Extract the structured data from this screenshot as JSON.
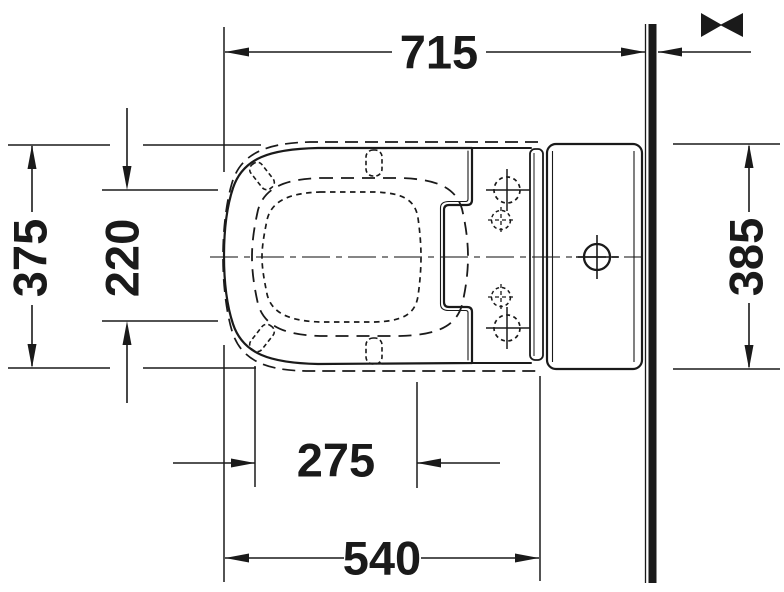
{
  "drawing": {
    "title": "toilet-with-cistern-plan-view-dimension-drawing",
    "units_implied": "mm",
    "colors": {
      "line": "#1a1a1a",
      "centerline": "#858585",
      "background": "#ffffff",
      "wall_fill": "#1a1a1a"
    },
    "dims": {
      "top": "715",
      "left_outer": "375",
      "left_inner": "220",
      "right": "385",
      "bottom_inner": "275",
      "bottom_outer": "540"
    },
    "symbols": {
      "variable_distance_icon": "><",
      "wall_section": "solid vertical bar",
      "centerline": "dash-dot horizontal axis",
      "fixing_holes": "4 dashed crosshair circles",
      "cistern_hole": "solid crosshair circle"
    }
  }
}
